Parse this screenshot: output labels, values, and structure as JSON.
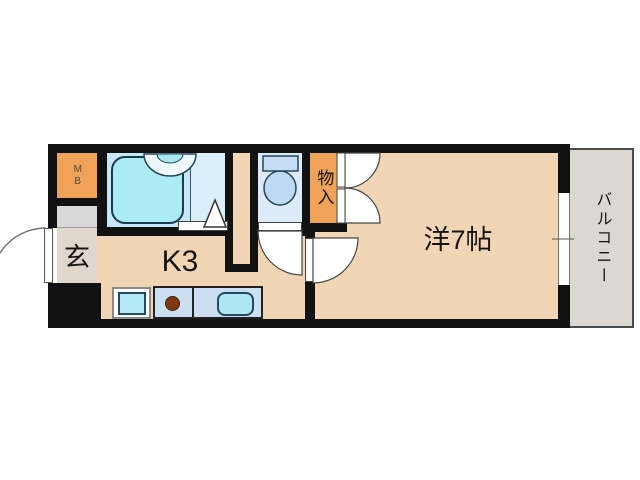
{
  "floor_plan": {
    "type": "apartment-1K-floorplan",
    "rooms": {
      "meter_box": {
        "label": "MB"
      },
      "entrance": {
        "label": "玄"
      },
      "kitchen": {
        "label": "K3"
      },
      "closet": {
        "label": "物入"
      },
      "western_room": {
        "label": "洋7帖"
      },
      "balcony": {
        "label": "バルコニー"
      }
    },
    "fixtures": [
      "bathtub",
      "washbasin",
      "folding-door",
      "toilet",
      "washer-space",
      "stove-burner",
      "kitchen-sink",
      "entrance-door",
      "closet-double-doors",
      "room-door",
      "toilet-door",
      "sliding-window"
    ],
    "colors": {
      "wall": "#111111",
      "floor_peach": "#F2D5B5",
      "accent_orange": "#F1A259",
      "entrance_gray": "#DFD7CC",
      "step_gray": "#D9D9D9",
      "bath_floor_left": "#C7E7F8",
      "bath_floor_right": "#DBEFFB",
      "toilet_floor": "#DCEAF9",
      "fixture_cyan": "#AAEBF4",
      "counter_blue": "#CBDEF2",
      "sink_cyan": "#ADE7F3",
      "burner_brown": "#7B3A12",
      "balcony_gray": "#DCD8D1"
    }
  }
}
